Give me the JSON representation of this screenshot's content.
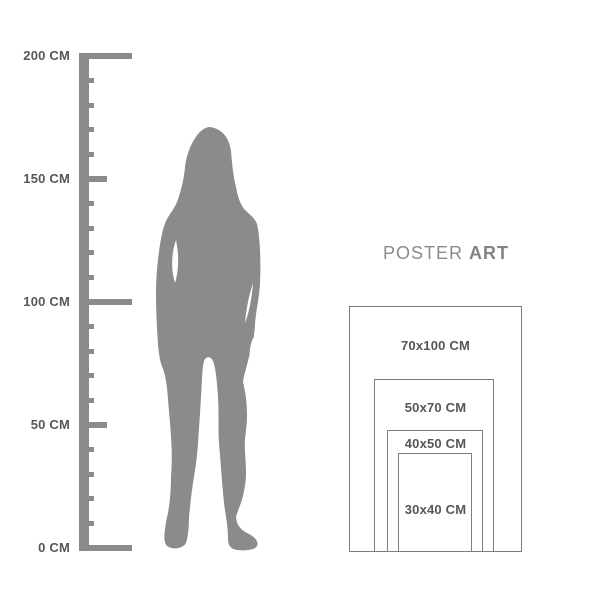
{
  "colors": {
    "background": "#ffffff",
    "figure_gray": "#8b8b8d",
    "ruler_gray": "#8b8b8d",
    "label_text": "#57575a",
    "brand_text": "#8b8b8d",
    "frame_border": "#7d7d80"
  },
  "ruler": {
    "unit": "CM",
    "labels": [
      "200 CM",
      "150 CM",
      "100 CM",
      "50 CM",
      "0 CM"
    ],
    "values": [
      200,
      150,
      100,
      50,
      0
    ],
    "minor_ticks_per_interval": 4,
    "minor_step_cm": 10
  },
  "figure": {
    "type": "woman-silhouette",
    "description": "standing woman silhouette used for scale"
  },
  "brand": {
    "regular": "POSTER",
    "bold": "ART"
  },
  "sizes": [
    {
      "label": "70x100 CM",
      "width_cm": 70,
      "height_cm": 100
    },
    {
      "label": "50x70 CM",
      "width_cm": 50,
      "height_cm": 70
    },
    {
      "label": "40x50 CM",
      "width_cm": 40,
      "height_cm": 50
    },
    {
      "label": "30x40 CM",
      "width_cm": 30,
      "height_cm": 40
    }
  ]
}
